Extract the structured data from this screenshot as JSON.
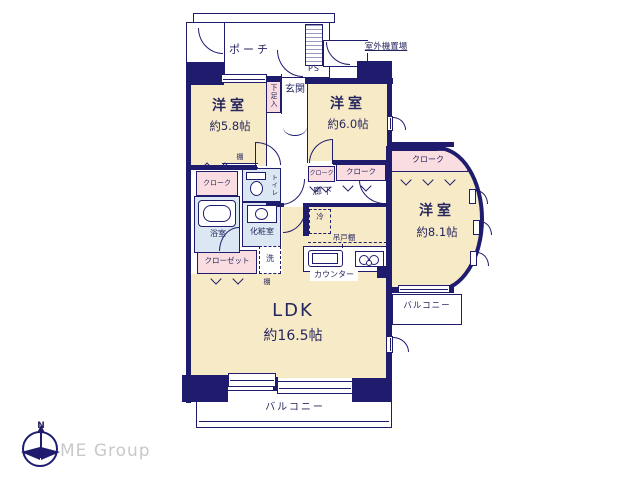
{
  "colors": {
    "wall": "#1f1c6e",
    "cream": "#f7eac7",
    "pink": "#fadde1",
    "blue": "#dbe7f3",
    "ink": "#26265e",
    "logo": "#c9c9c9",
    "bg": "#ffffff"
  },
  "labels": {
    "porch": "ポーチ",
    "outdoor_unit": "室外機置場",
    "ps": "PS",
    "shoe_cabinet": "下足入",
    "entrance": "玄関",
    "hallway": "廊下",
    "shelf_a": "棚",
    "shelf_b": "棚",
    "cloak_left": "クローク",
    "cloak_hall_a": "クローク",
    "cloak_hall_b": "クローク",
    "cloak_right": "クローク",
    "toilet": "トイレ",
    "bathroom": "浴室",
    "powder_room": "化粧室",
    "laundry": "洗",
    "closet": "クローゼット",
    "fridge": "冷",
    "hanging_cupboard": "吊戸棚",
    "counter": "カウンター",
    "balcony_right": "バルコニー",
    "balcony_bottom": "バルコニー"
  },
  "rooms": {
    "bedroom_small": {
      "type": "洋室",
      "area": "約5.8帖"
    },
    "bedroom_mid": {
      "type": "洋室",
      "area": "約6.0帖"
    },
    "bedroom_large": {
      "type": "洋室",
      "area": "約8.1帖"
    },
    "ldk": {
      "type": "LDK",
      "area": "約16.5帖"
    }
  },
  "branding": {
    "company": "ME Group",
    "compass_north": "N"
  }
}
